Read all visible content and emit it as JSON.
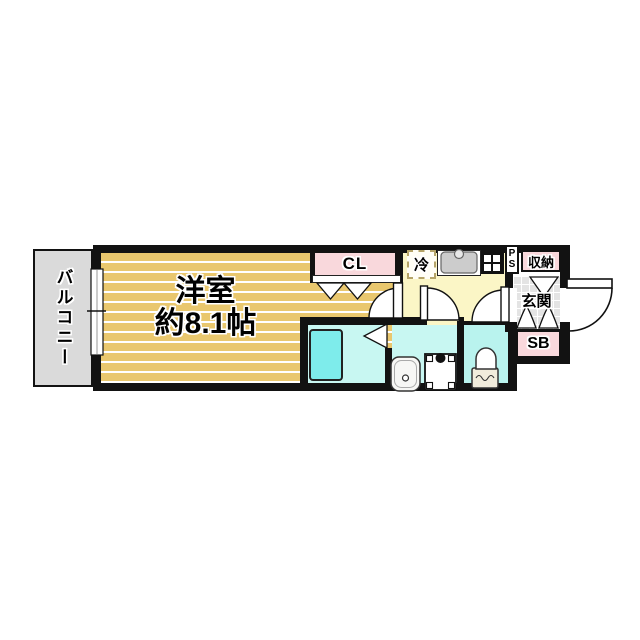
{
  "floor_plan": {
    "rooms": {
      "balcony": "バルコニー",
      "western_room": "洋室",
      "western_room_size": "約8.1帖",
      "closet": "CL",
      "refrigerator": "冷",
      "pipe_space_p": "P",
      "pipe_space_s": "S",
      "storage": "収納",
      "entrance": "玄関",
      "shoe_box": "SB"
    },
    "colors": {
      "room_floor": "#e9c76e",
      "kitchen_floor": "#fbf6c6",
      "wet_area": "#c8f7f2",
      "toilet_area": "#b9f3ee",
      "bathtub": "#7eeceb",
      "closet_pink": "#f9d8dc",
      "balcony_gray": "#dadada",
      "entrance_tile": "#e4e4e4",
      "wall": "#121212"
    },
    "icons": [
      "window-icon",
      "bathtub-icon",
      "kitchen-sink-icon",
      "gas-stove-icon",
      "washbasin-icon",
      "washing-machine-icon",
      "toilet-icon",
      "door-swing-icon",
      "folding-door-icon",
      "front-door-swing-icon"
    ]
  }
}
